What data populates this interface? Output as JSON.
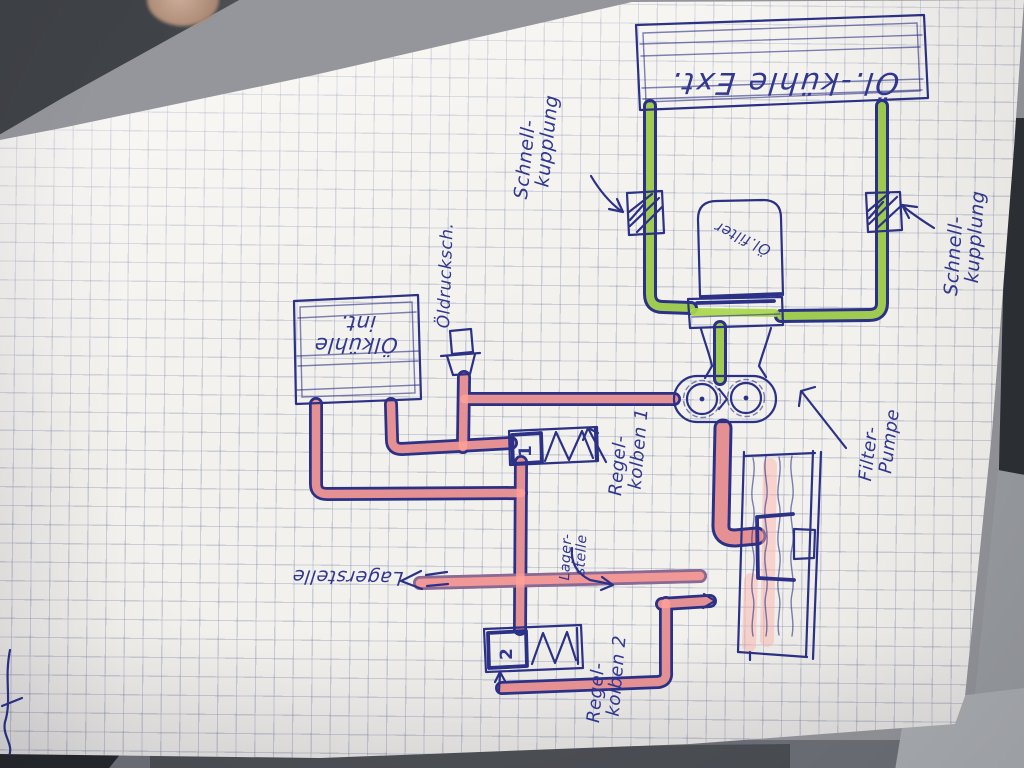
{
  "diagram": {
    "labels": {
      "cooler_ext": "Öl.-kühle Ext.",
      "cooler_int": [
        "Ölkühle",
        "int."
      ],
      "oil_filter": "Öl.filter",
      "pressure_switch": "Öldrucksch.",
      "quick_coupling": [
        "Schnell-",
        "kupplung"
      ],
      "filter_pump": [
        "Filter-",
        "Pumpe"
      ],
      "control_piston_1": [
        "Regel-",
        "kolben 1"
      ],
      "control_piston_2": [
        "Regel-",
        "kolben 2"
      ],
      "bearing_points_main": "Lagerstelle",
      "bearing_point_small": [
        "Lager-",
        "stelle"
      ],
      "valve_1_number": "1",
      "valve_2_number": "2"
    },
    "colors": {
      "ink_blue": "#2b3186",
      "oil_highlight_pink": "#ff9e96",
      "coolant_highlight_green": "#a9d84c",
      "paper": "#f3f1ed",
      "grid_line": "#6e7da0"
    }
  }
}
